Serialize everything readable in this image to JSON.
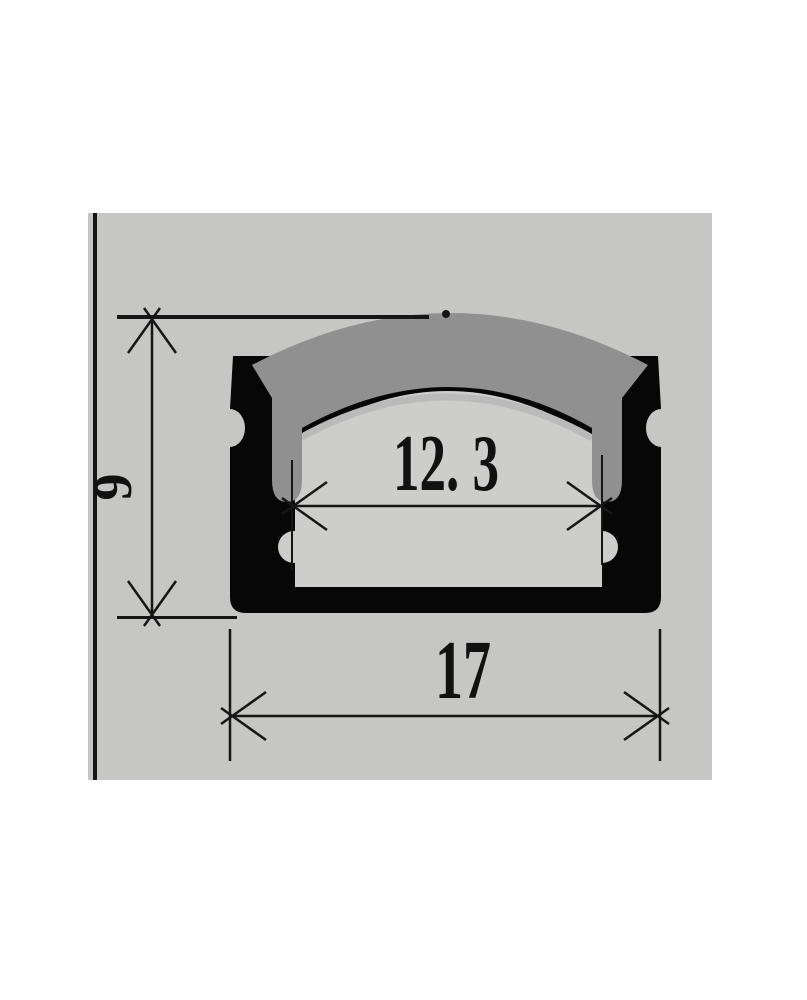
{
  "drawing": {
    "kind": "technical-cross-section-diagram",
    "dimensions": {
      "height": {
        "label": "9"
      },
      "inner_width": {
        "label": "12. 3"
      },
      "outer_width": {
        "label": "17"
      }
    },
    "colors": {
      "page": "#ffffff",
      "canvas": "#c6c7c5",
      "profile_body": "#070707",
      "diffuser": "#8f908f",
      "cavity": "#cdcdcb",
      "highlight": "#bababa",
      "line": "#161616"
    }
  }
}
